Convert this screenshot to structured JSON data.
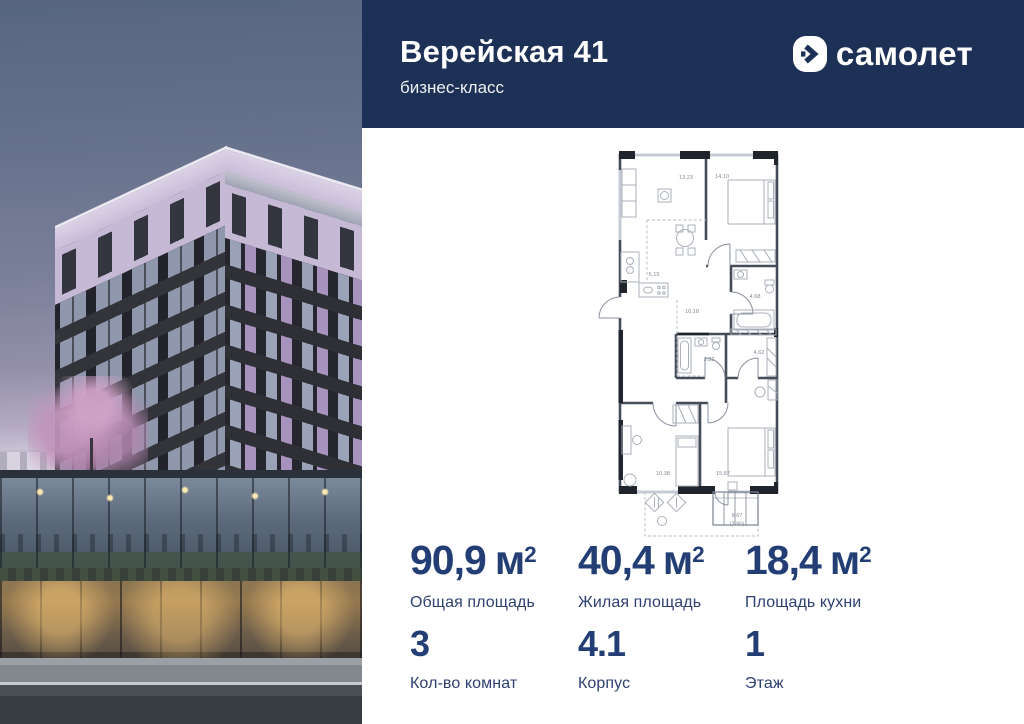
{
  "header": {
    "project_title": "Верейская 41",
    "project_class": "бизнес-класс",
    "brand_name": "самолет"
  },
  "plan": {
    "rooms": [
      {
        "name": "living-kitchen",
        "area": "13,23"
      },
      {
        "name": "bedroom-1",
        "area": "14,10"
      },
      {
        "name": "kitchen-zone",
        "area": "5,15"
      },
      {
        "name": "corridor",
        "area": "16,18"
      },
      {
        "name": "bathroom-1",
        "area": "4,68"
      },
      {
        "name": "bathroom-2",
        "area": "3,82"
      },
      {
        "name": "hall",
        "area": "4,62"
      },
      {
        "name": "room-2",
        "area": "10,38"
      },
      {
        "name": "bedroom-2",
        "area": "15,87"
      }
    ],
    "balcony": {
      "area": "9,67",
      "reduced_area": "(2,90)"
    }
  },
  "stats": {
    "sup": "2",
    "areas": [
      {
        "value": "90,9",
        "unit": "м",
        "label": "Общая площадь"
      },
      {
        "value": "40,4",
        "unit": "м",
        "label": "Жилая площадь"
      },
      {
        "value": "18,4",
        "unit": "м",
        "label": "Площадь кухни"
      }
    ],
    "info": [
      {
        "value": "3",
        "label": "Кол-во комнат"
      },
      {
        "value": "4.1",
        "label": "Корпус"
      },
      {
        "value": "1",
        "label": "Этаж"
      }
    ]
  },
  "colors": {
    "header_bg": "#1d3156",
    "accent_text": "#223e74",
    "plan_wall": "#454c5a",
    "lilac_facade": "#c6b9d6"
  }
}
